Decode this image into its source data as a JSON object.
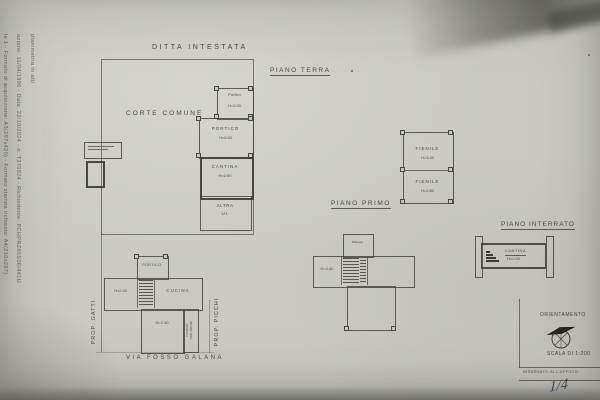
{
  "colors": {
    "paper": "#cac9c4",
    "ink": "#4a4843",
    "pen": "#3b3b47"
  },
  "margin_text": {
    "line_top": "planimetria in atti",
    "line_mid": "azione: 11/04/1996 - Data: 22/10/2024 - n. T370824 - Richiedente: PCHPRZ65S06I441U",
    "line_outer": "le 1 - Formato di acquisizione: A3(297x420) - Formato stampa richiesto: A4(210x297)"
  },
  "titles": {
    "ditta": "DITTA INTESTATA",
    "piano_terra": "PIANO TERRA",
    "piano_primo": "PIANO PRIMO",
    "piano_interrato": "PIANO INTERRATO"
  },
  "site_labels": {
    "corte_comune": "CORTE COMUNE",
    "via": "VIA FOSSO GALANA",
    "prop_gatti": "PROP. GATTI",
    "prop_picchi": "PROP. PICCHI",
    "cavedio_line1": "CAVEDIO",
    "cavedio_line2": "NON ABITAB."
  },
  "rooms": {
    "annex": [
      {
        "label": "Portico",
        "height": "H=3.00"
      },
      {
        "label": "PORTICO",
        "height": "H=5.50"
      },
      {
        "label": "CANTINA",
        "height": "H=2.60"
      },
      {
        "label": "ALTRA",
        "height": "U.I."
      }
    ],
    "fienile": [
      {
        "label": "FIENILE",
        "height": "H=3.40"
      },
      {
        "label": "FIENILE",
        "height": "H=2.80"
      }
    ],
    "primo": {
      "top_label": "Balcone",
      "left_height": "H=2.40"
    },
    "interrato": {
      "label": "CANTINA",
      "height": "H=2.00"
    },
    "main": {
      "portico": "PORTICO",
      "left_height": "H=2.40",
      "kitchen": "CUCINA",
      "bottom_height": "H=2.40"
    }
  },
  "footer": {
    "orientamento": "ORIENTAMENTO",
    "scala": "SCALA DI 1:200",
    "riservato": "RISERVATO ALL'UFFICIO",
    "handwritten": "1/4"
  }
}
